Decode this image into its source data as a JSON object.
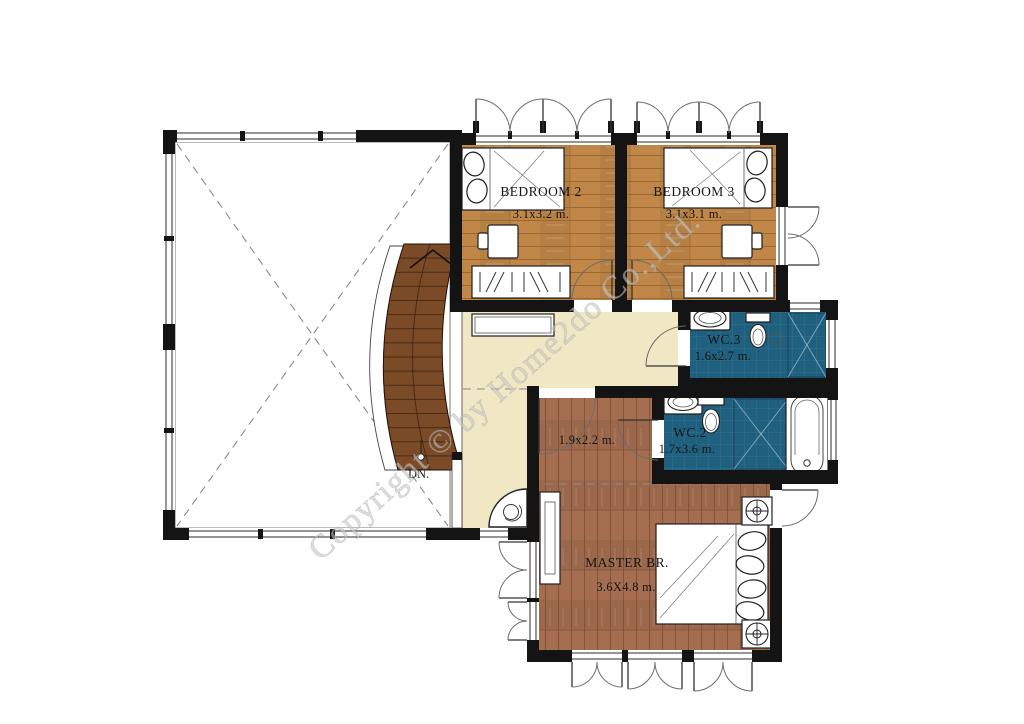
{
  "watermark": {
    "text": "Copyright © by Home2do Co.,Ltd."
  },
  "rooms": {
    "bedroom2": {
      "name": "BEDROOM 2",
      "dims": "3.1x3.2 m."
    },
    "bedroom3": {
      "name": "BEDROOM 3",
      "dims": "3.1x3.1 m."
    },
    "wc3": {
      "name": "WC.3",
      "dims": "1.6x2.7 m."
    },
    "wc2": {
      "name": "WC.2",
      "dims": "1.7x3.6 m."
    },
    "dressing": {
      "dims": "1.9x2.2 m."
    },
    "master": {
      "name": "MASTER BR.",
      "dims": "3.6X4.8 m."
    },
    "stair": {
      "label": "DN."
    }
  },
  "colors": {
    "wall": "#141414",
    "bedroom_floor": "#c08749",
    "master_floor": "#a56e50",
    "hall_floor": "#f0e8c4",
    "bath_tile": "#20607f",
    "stair_wood": "#7b4a27",
    "watermark": "#c9c9c9"
  }
}
